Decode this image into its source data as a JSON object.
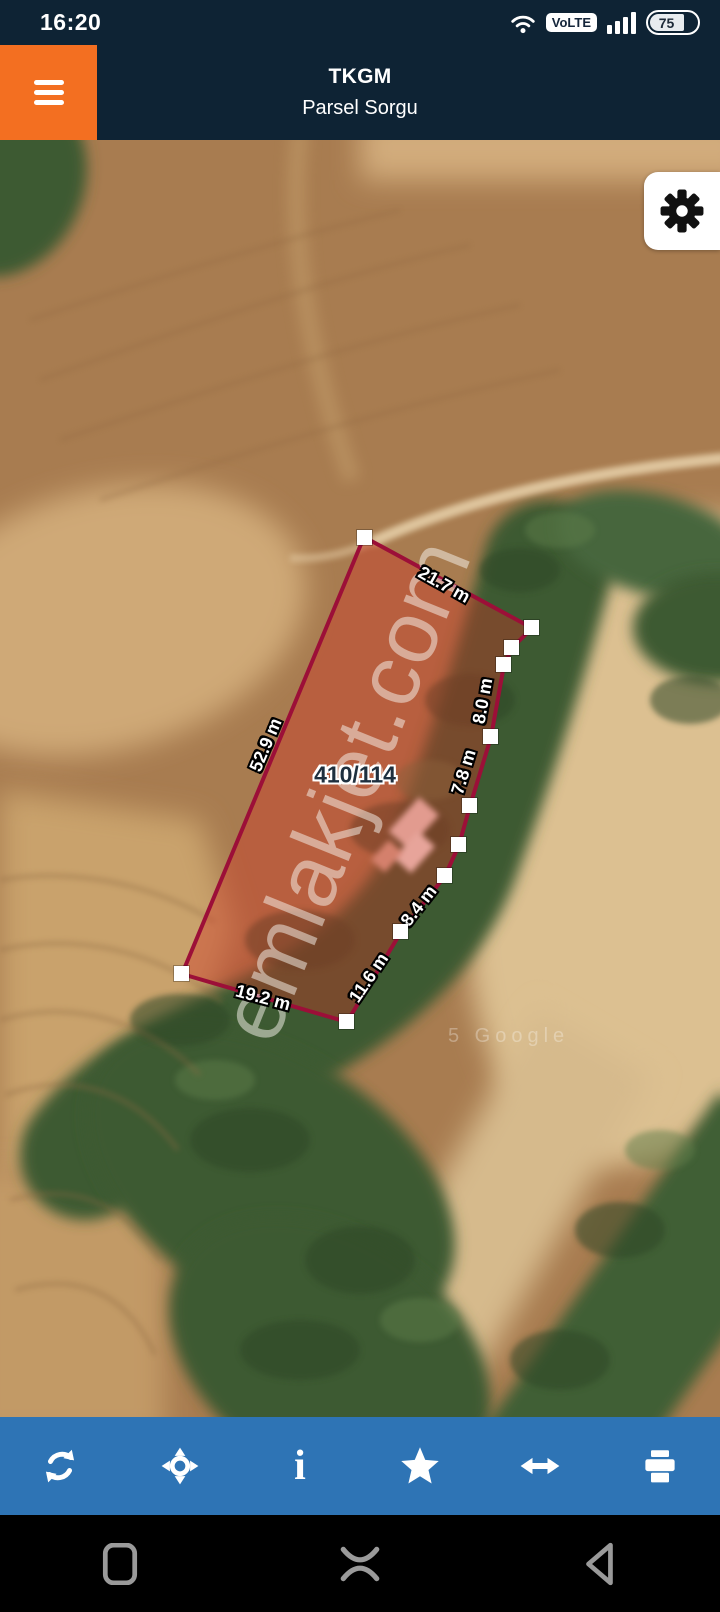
{
  "status_bar": {
    "time": "16:20",
    "volte_label": "VoLTE",
    "battery_level": "75",
    "icons": [
      "wifi-icon",
      "volte-badge",
      "signal-bars-icon",
      "battery-icon"
    ]
  },
  "header": {
    "title": "TKGM",
    "subtitle": "Parsel Sorgu",
    "menu_icon": "hamburger-menu-icon",
    "accent_orange": "#f36f21",
    "navy": "#0e2334"
  },
  "map": {
    "type": "satellite",
    "parcel_number": "410/114",
    "watermark": "emlakjet.com",
    "attribution": "5 Google",
    "settings_icon": "gear-icon",
    "parcel_stroke": "#9c0f38",
    "parcel_fill": "rgba(208,52,38,0.4)",
    "measurements": [
      {
        "text": "21.7 m"
      },
      {
        "text": "52.9 m"
      },
      {
        "text": "8.0 m"
      },
      {
        "text": "7.8 m"
      },
      {
        "text": "8.4 m"
      },
      {
        "text": "11.6 m"
      },
      {
        "text": "19.2 m"
      }
    ]
  },
  "toolbar": {
    "background": "#2e74b5",
    "icons": [
      "refresh-icon",
      "pan-location-icon",
      "info-icon",
      "star-icon",
      "swap-horizontal-icon",
      "print-icon"
    ]
  },
  "android_nav": {
    "icons": [
      "recents-icon",
      "home-icon",
      "back-icon"
    ]
  }
}
